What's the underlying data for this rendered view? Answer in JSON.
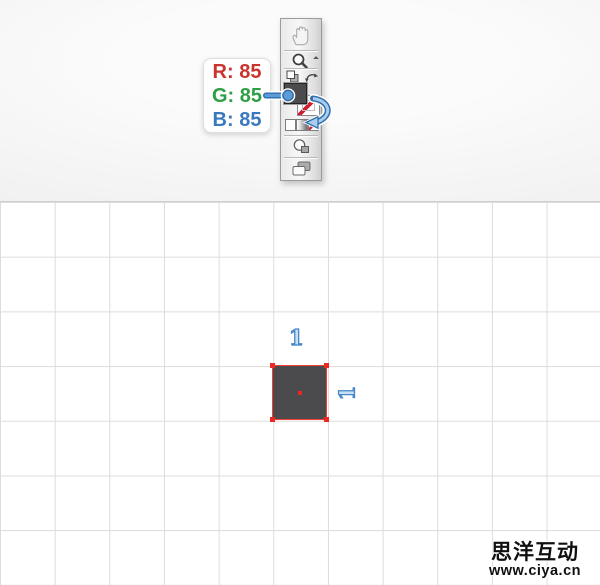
{
  "header": {
    "tooltip": {
      "lines": [
        {
          "id": "r",
          "label": "R: 85",
          "color": "#c9342c"
        },
        {
          "id": "g",
          "label": "G: 85",
          "color": "#2f9e44"
        },
        {
          "id": "b",
          "label": "B: 85",
          "color": "#3a79bd"
        }
      ]
    },
    "toolbar": {
      "tools": [
        {
          "icon": "hand-icon"
        },
        {
          "icon": "zoom-icon"
        },
        {
          "icon": "default-fill-stroke-icon"
        },
        {
          "icon": "swap-fill-stroke-icon"
        },
        {
          "icon": "fill-swatch"
        },
        {
          "icon": "stroke-swatch"
        },
        {
          "icon": "color-button"
        },
        {
          "icon": "gradient-button"
        },
        {
          "icon": "none-button"
        },
        {
          "icon": "draw-mode-icon"
        },
        {
          "icon": "screen-mode-icon"
        }
      ],
      "fill_color": "#4b4b4d",
      "stroke_value": "none"
    },
    "annotation_color": "#5b9bd8"
  },
  "canvas": {
    "width_label": "1",
    "height_label": "1",
    "square": {
      "fill": "#4b4b4d",
      "selection_color": "#ef4137"
    },
    "grid_line_color": "#dcdcdc"
  },
  "watermark": {
    "name": "思洋互动",
    "url": "www.ciya.cn"
  }
}
